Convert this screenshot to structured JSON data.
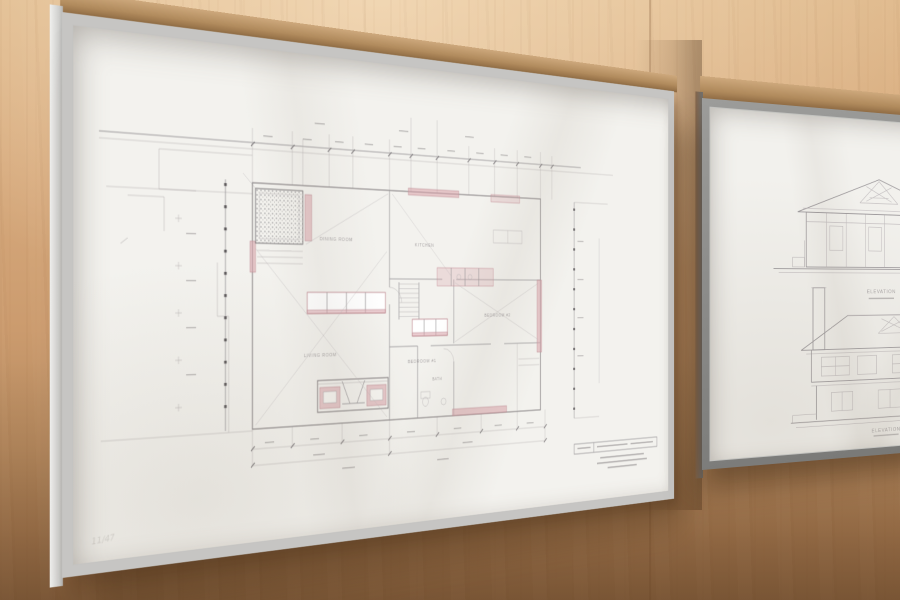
{
  "colors": {
    "wall_wood": "#d2a377",
    "wall_shadow": "#8f6742",
    "left_frame_metal": "#c9c9c7",
    "right_frame_metal": "#8b8b89",
    "frame_top_face": "#b08a5c",
    "paper": "#f3f2ee",
    "pencil_line": "#9b979a",
    "accent_pink": "#d9a3aa"
  },
  "left_artwork": {
    "kind": "architectural floor plan drawing",
    "frame_finish": "silver",
    "room_labels": [
      "DINING ROOM",
      "KITCHEN",
      "LIVING ROOM",
      "BEDROOM #1",
      "BEDROOM #2",
      "BATH"
    ],
    "inscription": "11/47"
  },
  "right_artwork": {
    "kind": "architectural elevation drawings",
    "frame_finish": "gray",
    "captions": [
      "ELEVATION",
      "ELEVATION"
    ]
  }
}
